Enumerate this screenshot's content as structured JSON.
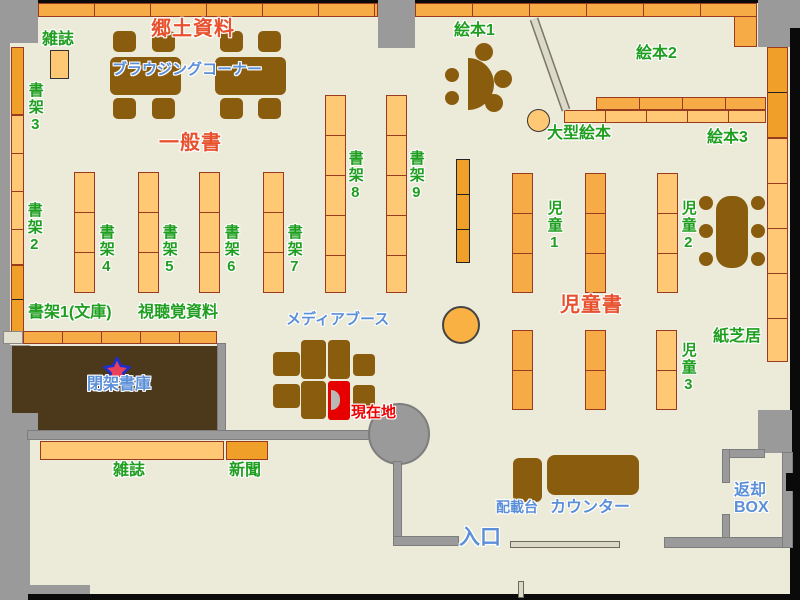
{
  "map_title": "library-floor-map",
  "labels": {
    "kyodo_shiryo": "郷土資料",
    "zasshi_top": "雑誌",
    "browsing_corner": "ブラウジングコーナー",
    "shoka3": "書架3",
    "ippansho": "一般書",
    "ehon1": "絵本1",
    "ehon2": "絵本2",
    "ogata_ehon": "大型絵本",
    "ehon3": "絵本3",
    "shoka2": "書架2",
    "shoka4": "書架4",
    "shoka5": "書架5",
    "shoka6": "書架6",
    "shoka7": "書架7",
    "shoka8": "書架8",
    "shoka9": "書架9",
    "jido1": "児童1",
    "jido2": "児童2",
    "jido3": "児童3",
    "jidosho": "児童書",
    "kamishibai": "紙芝居",
    "shoka1_bunko": "書架1(文庫)",
    "shichokaku_shiryo": "視聴覚資料",
    "media_booth": "メディアブース",
    "heika_shoko": "閉架書庫",
    "genzaichi": "現在地",
    "zasshi_bottom": "雑誌",
    "shinbun": "新聞",
    "haisaidai": "配載台",
    "counter": "カウンター",
    "henkyaku_box_lines": [
      "返却",
      "BOX"
    ],
    "iriguchi": "入口"
  },
  "colors": {
    "floor": "#ecebd9",
    "outside_gray": "#9a9a9a",
    "shelf_orange": "#f6ab46",
    "shelf_light_orange": "#ffc874",
    "shelf_dark_orange": "#f0a028",
    "furniture_brown": "#8a5c0e",
    "closed_stacks_brown": "#4c381b",
    "label_green": "#1f9e1f",
    "heading_red": "#e8512e",
    "label_blue": "#5b8fd8",
    "current_location_red": "#f00000",
    "booth_red": "#e60000",
    "star_fill": "#e8405a",
    "star_border": "#1c2fd0"
  }
}
